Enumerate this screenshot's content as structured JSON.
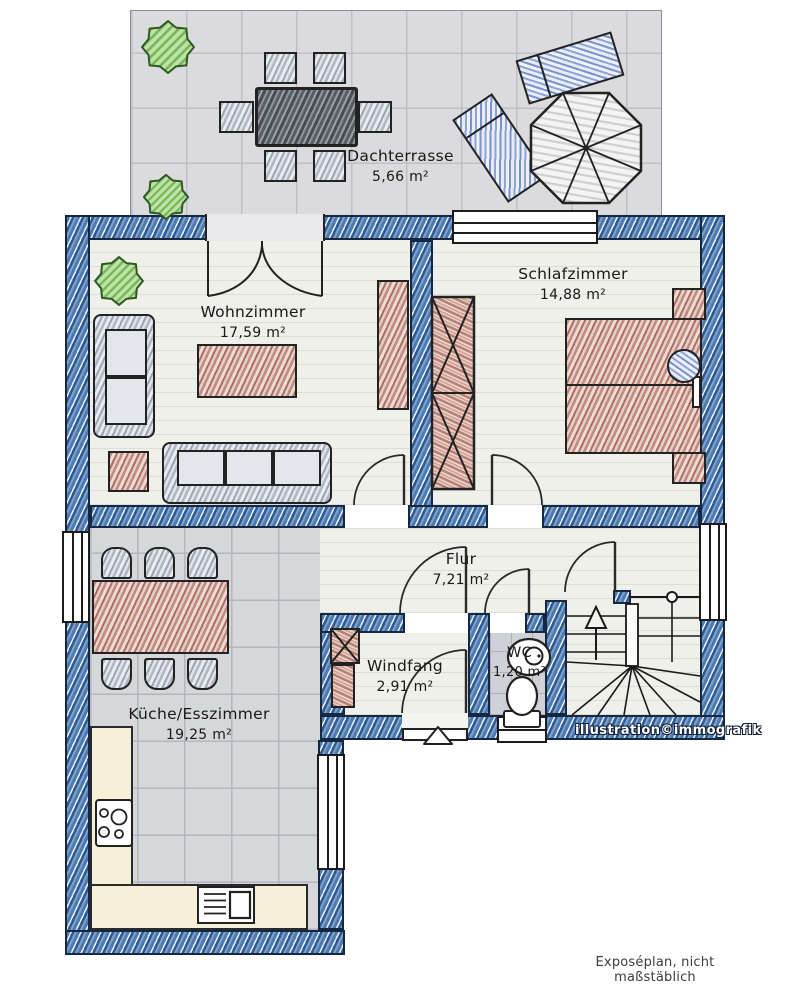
{
  "rooms": {
    "dachterrasse": {
      "name": "Dachterrasse",
      "area": "5,66 m²"
    },
    "wohnzimmer": {
      "name": "Wohnzimmer",
      "area": "17,59 m²"
    },
    "schlafzimmer": {
      "name": "Schlafzimmer",
      "area": "14,88 m²"
    },
    "flur": {
      "name": "Flur",
      "area": "7,21 m²"
    },
    "windfang": {
      "name": "Windfang",
      "area": "2,91 m²"
    },
    "wc": {
      "name": "WC",
      "area": "1,20 m²"
    },
    "kueche": {
      "name": "Küche/Esszimmer",
      "area": "19,25 m²"
    }
  },
  "credits": {
    "watermark": "illustration©immografik",
    "footer": "Exposéplan, nicht maßstäblich"
  },
  "colors": {
    "wall_blue": "#3e6fa8",
    "floor_light": "#eef0e9",
    "kitchen_tile": "#d5d7db",
    "terrace_tile": "#dbdbde",
    "furniture_red": "#b97f72",
    "furniture_gray": "#9fa9b6",
    "furniture_blue": "#8fa3d3",
    "plant_green": "#77b558",
    "counter_cream": "#f7f0d9",
    "outline": "#222222"
  }
}
